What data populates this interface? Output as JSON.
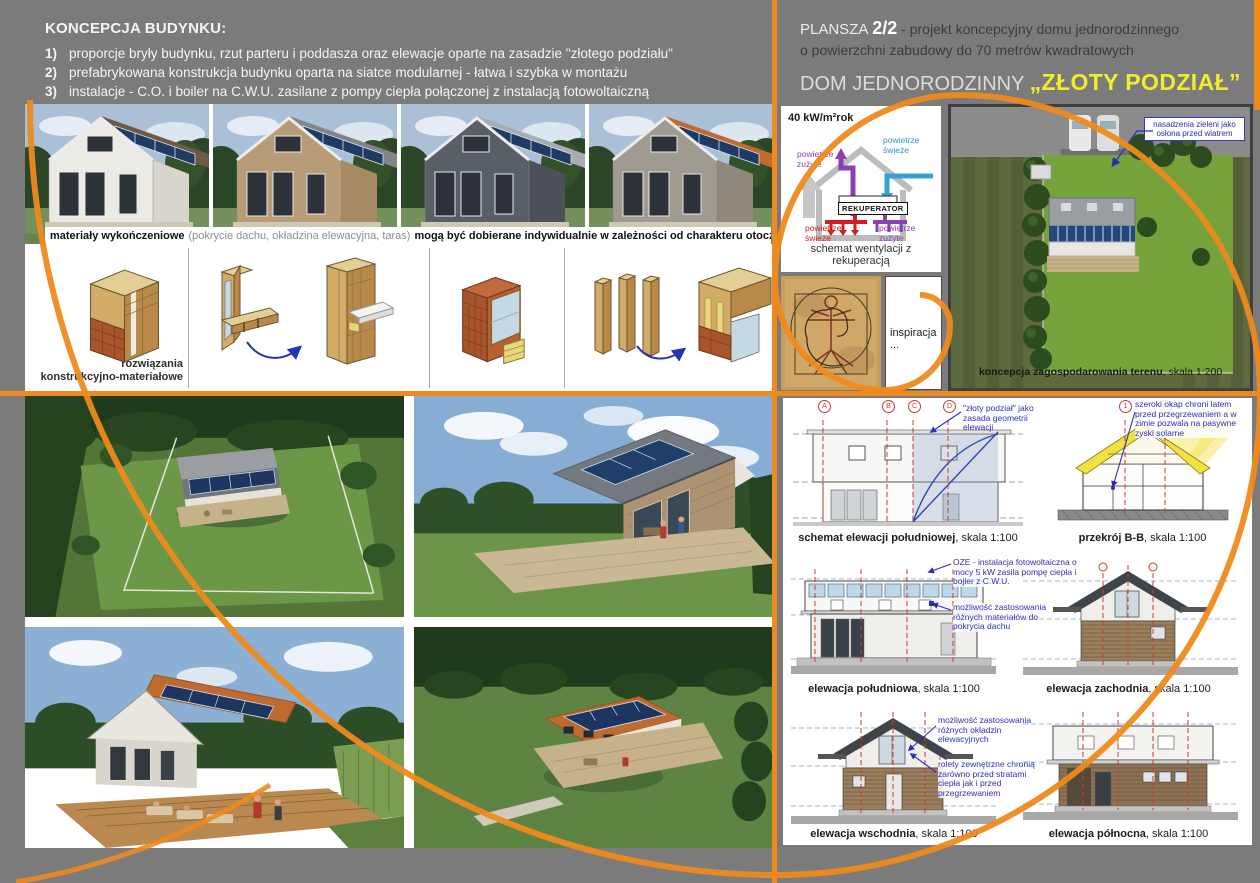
{
  "header_left": {
    "heading": "KONCEPCJA BUDYNKU:",
    "items": [
      {
        "num": "1)",
        "text": "proporcje bryły budynku, rzut parteru i poddasza oraz elewacje oparte na zasadzie \"złotego podziału\""
      },
      {
        "num": "2)",
        "text": "prefabrykowana konstrukcja budynku oparta na siatce modularnej - łatwa i szybka w montażu"
      },
      {
        "num": "3)",
        "text": "instalacje - C.O. i boiler na C.W.U. zasilane z pompy ciepła połączonej z instalacją fotowoltaiczną"
      }
    ]
  },
  "header_right": {
    "plansza_label": "PLANSZA",
    "plansza_number": "2/2",
    "desc1": "- projekt koncepcyjny domu jednorodzinnego",
    "desc2": "o powierzchni zabudowy do 70 metrów kwadratowych",
    "title_prefix": "DOM JEDNORODZINNY ",
    "title_name": "„ZŁOTY PODZIAŁ”"
  },
  "materials_caption": {
    "part1": "materiały wykończeniowe",
    "part2": "(pokrycie dachu, okładzina elewacyjna, taras)",
    "part3": "mogą być dobierane indywidualnie w zależności od charakteru otoczenia w konkretnej lokalizacji"
  },
  "materials_renders": [
    {
      "facade": "#eceae4",
      "roof": "#6e5948",
      "side": "#d8d5cd"
    },
    {
      "facade": "#b79c77",
      "roof": "#82858a",
      "side": "#a78a63"
    },
    {
      "facade": "#595f66",
      "roof": "#a7adb3",
      "side": "#4b5157"
    },
    {
      "facade": "#a09a90",
      "roof": "#c06a2e",
      "side": "#8e887e"
    }
  ],
  "construction": {
    "label_line1": "rozwiązania",
    "label_line2": "konstrukcyjno-materiałowe"
  },
  "ventilation": {
    "energy": "40 kW/m²rok",
    "recuperator": "REKUPERATOR",
    "top_left": "powietrze zużyte",
    "top_right": "powietrze świeże",
    "bottom_left": "powietrze świeże",
    "bottom_right": "powietrze zużyte",
    "caption": "schemat wentylacji z rekuperacją"
  },
  "inspiration": {
    "label": "inspiracja ..."
  },
  "site_plan": {
    "caption_bold": "koncepcja zagospodarowania terenu",
    "caption_rest": ", skala 1:200",
    "annotation": "nasadzenia zieleni jako osłona przed wiatrem"
  },
  "elevations": {
    "schemat": {
      "caption_bold": "schemat elewacji południowej",
      "caption_rest": ", skala 1:100",
      "axes": [
        "A",
        "B",
        "C",
        "D"
      ],
      "annotation": "\"złoty podział\" jako zasada geometrii elewacji"
    },
    "przekroj": {
      "caption_bold": "przekrój B-B",
      "caption_rest": ", skala 1:100",
      "axes": [
        "1",
        "2"
      ],
      "annotation": "szeroki okap chroni latem przed przegrzewaniem a w zimie pozwala na pasywne zyski solarne"
    },
    "poludniowa": {
      "caption_bold": "elewacja południowa",
      "caption_rest": ", skala 1:100",
      "annotation_oze": "OZE - instalacja fotowoltaiczna o mocy 5 kW zasila pompę ciepła i bojler z C.W.U.",
      "annotation_roof": "możliwość zastosowania różnych materiałów do pokrycia dachu"
    },
    "zachodnia": {
      "caption_bold": "elewacja zachodnia",
      "caption_rest": ", skala 1:100"
    },
    "wschodnia": {
      "caption_bold": "elewacja wschodnia",
      "caption_rest": ", skala 1:100",
      "annotation_cladding": "możliwość zastosowania różnych okładzin elewacyjnych",
      "annotation_blinds": "rolety zewnętrzne chronią zarówno przed stratami ciepła jak i przed przegrzewaniem"
    },
    "polnocna": {
      "caption_bold": "elewacja północna",
      "caption_rest": ", skala 1:100"
    }
  },
  "colors": {
    "accent_orange": "#ee8a1e",
    "title_yellow": "#f0ee2a",
    "annotation_blue": "#2d2dbb",
    "axis_red": "#cc3a30",
    "duct_purple": "#8d3fae",
    "duct_blue": "#35a1d6",
    "duct_red": "#cf1f1f"
  }
}
